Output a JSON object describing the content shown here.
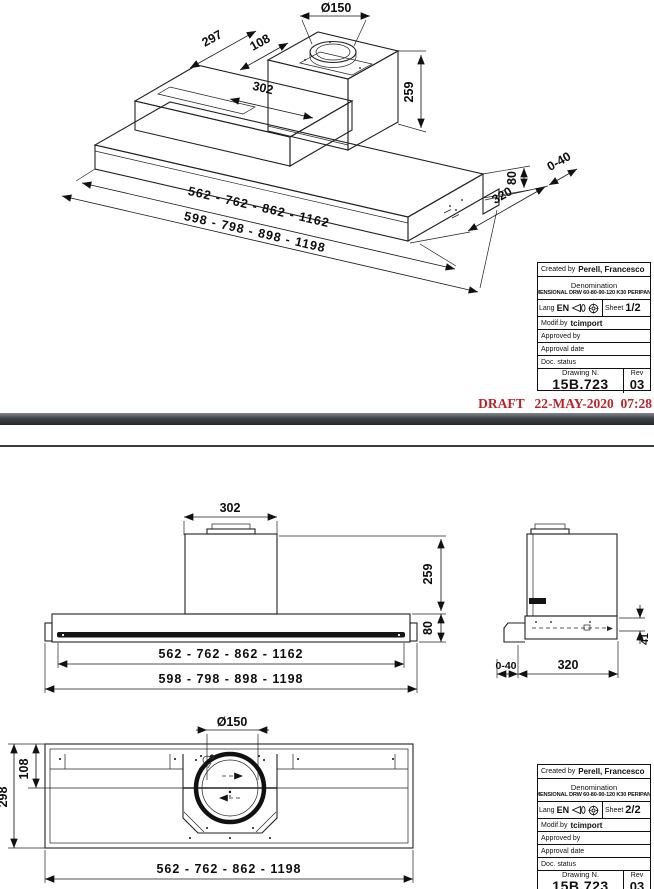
{
  "colors": {
    "draft_red": "#b9242a",
    "line": "#222222",
    "separator": "#3c4247"
  },
  "pages": {
    "page1": {
      "draft_stamp": "DRAFT   22-MAY-2020  07:28",
      "iso_dims": {
        "collar_diameter": "Ø150",
        "depth_back": "297",
        "offset_top": "108",
        "chimney_width": "302",
        "chimney_height": "259",
        "body_height": "80",
        "body_depth": "320",
        "adjust_range": "0-40",
        "widths_inner": "562 - 762 - 862 - 1162",
        "widths_outer": "598 - 798 - 898 - 1198"
      },
      "title_block": {
        "created_by_label": "Created by",
        "created_by_value": "Perell, Francesco",
        "denomination_label": "Denomination",
        "denomination_value": "DIMENSIONAL DRW 60-80-90-120 K30 PERIPANEL",
        "lang_label": "Lang",
        "lang_value": "EN",
        "sheet_label": "Sheet",
        "sheet_value": "1/2",
        "modif_label": "Modif.by",
        "modif_value": "tcimport",
        "approved_by_label": "Approved by",
        "approval_date_label": "Approval date",
        "doc_status_label": "Doc. status",
        "drawing_n_label": "Drawing N.",
        "drawing_n_value": "15B.723",
        "rev_label": "Rev",
        "rev_value": "03"
      }
    },
    "page2": {
      "front_view": {
        "chimney_width": "302",
        "chimney_height": "259",
        "body_height": "80",
        "widths_inner": "562 - 762 - 862 - 1162",
        "widths_outer": "598 - 798 - 898 - 1198"
      },
      "side_view": {
        "adjust_range": "0-40",
        "depth": "320",
        "bracket_height": "41"
      },
      "bottom_view": {
        "collar_diameter": "Ø150",
        "inner_offset": "108",
        "depth_inner": "298",
        "widths": "562 - 762 - 862 - 1198"
      },
      "title_block": {
        "created_by_label": "Created by",
        "created_by_value": "Perell, Francesco",
        "denomination_label": "Denomination",
        "denomination_value": "DIMENSIONAL DRW 60-80-90-120 K30 PERIPANEL",
        "lang_label": "Lang",
        "lang_value": "EN",
        "sheet_label": "Sheet",
        "sheet_value": "2/2",
        "modif_label": "Modif.by",
        "modif_value": "tcimport",
        "approved_by_label": "Approved by",
        "approval_date_label": "Approval date",
        "doc_status_label": "Doc. status",
        "drawing_n_label": "Drawing N.",
        "drawing_n_value": "15B.723",
        "rev_label": "Rev",
        "rev_value": "03"
      }
    }
  }
}
